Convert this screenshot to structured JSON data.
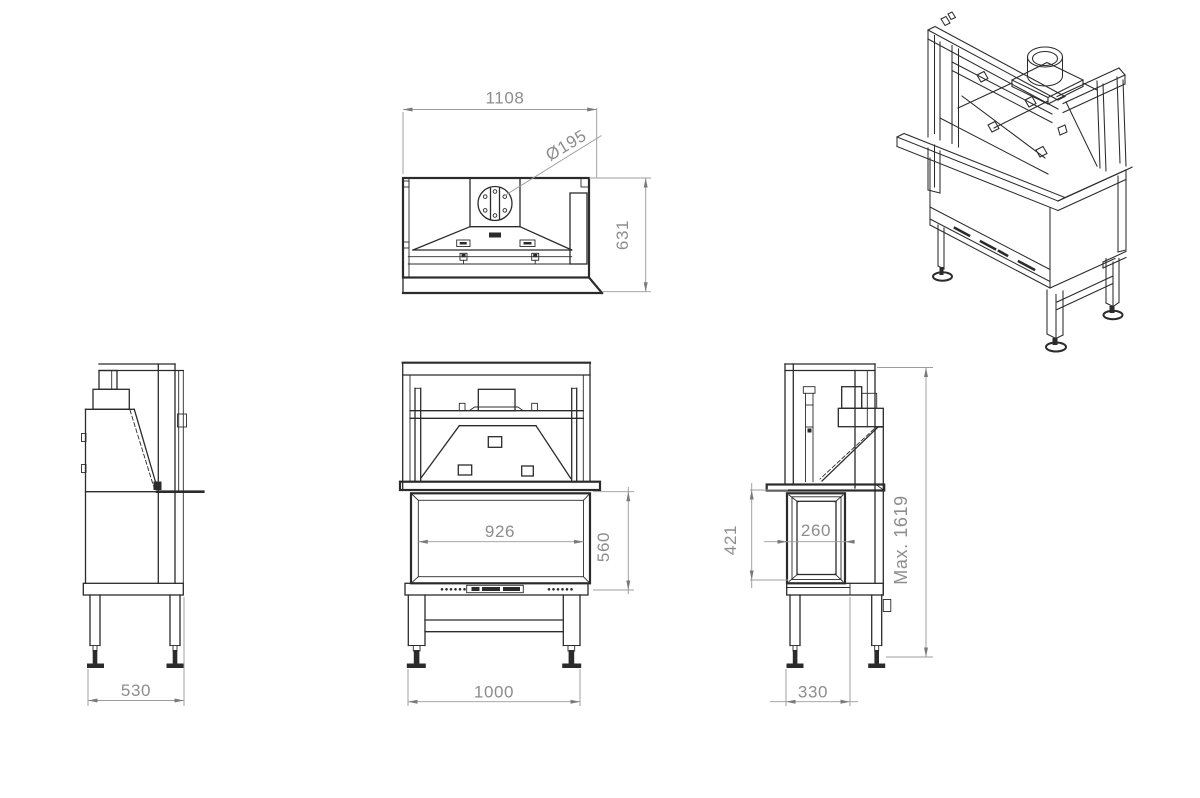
{
  "drawing_type": "fireplace insert technical drawing",
  "colors": {
    "background": "#ffffff",
    "line": "#2b2b2b",
    "dimension_line": "#9c9c9c",
    "dimension_arrow": "#7a7a7a",
    "dimension_text": "#8d8d8d"
  },
  "views": {
    "top_view": {
      "width_label": "1108",
      "flue_diameter_label": "Ø195",
      "depth_label": "631"
    },
    "left_side_view": {
      "depth_label": "530"
    },
    "front_view": {
      "glass_width_label": "926",
      "firebox_height_label": "560",
      "overall_width_label": "1000"
    },
    "right_side_view": {
      "side_glass_height_label": "421",
      "side_glass_width_label": "260",
      "leg_depth_label": "330",
      "max_height_label": "Max. 1619"
    }
  }
}
